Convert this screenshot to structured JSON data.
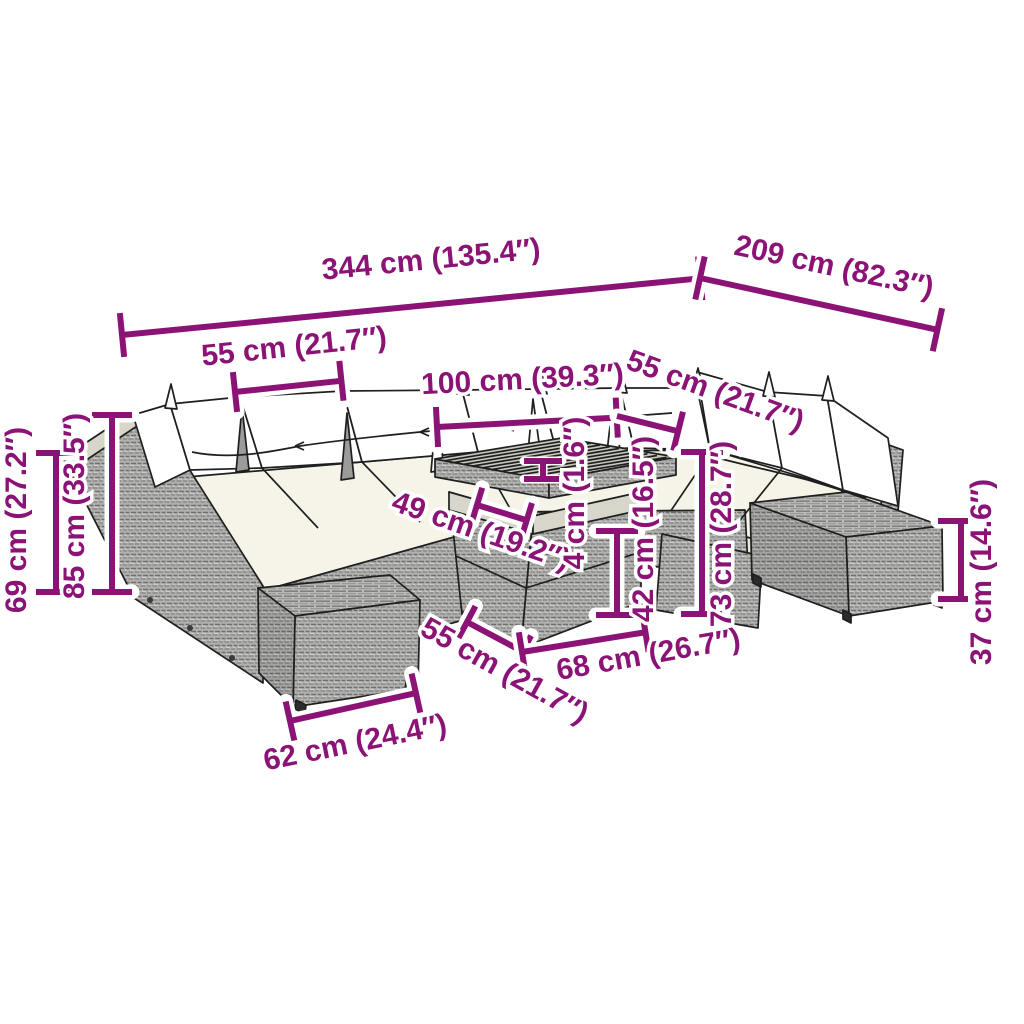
{
  "figure": {
    "type": "product-dimension-diagram",
    "subject": "rattan garden lounge set with corner sofas, coffee table and footstools",
    "accent_color": "#8C1376",
    "background_color": "#FFFFFF",
    "unit_system": "cm and inches"
  },
  "dims": {
    "overall_width": {
      "label": "344 cm (135.4″)",
      "cm": 344,
      "in": 135.4
    },
    "right_depth": {
      "label": "209 cm (82.3″)",
      "cm": 209,
      "in": 82.3
    },
    "seat_width_back_left": {
      "label": "55 cm (21.7″)",
      "cm": 55,
      "in": 21.7
    },
    "corner_opening_width": {
      "label": "100 cm (39.3″)",
      "cm": 100,
      "in": 39.3
    },
    "seat_width_back_right": {
      "label": "55 cm (21.7″)",
      "cm": 55,
      "in": 21.7
    },
    "tabletop_depth": {
      "label": "49 cm (19.2″)",
      "cm": 49,
      "in": 19.2
    },
    "tabletop_thickness": {
      "label": "4 cm (1.6″)",
      "cm": 4,
      "in": 1.6
    },
    "table_height": {
      "label": "42 cm (16.5″)",
      "cm": 42,
      "in": 16.5
    },
    "sofa_height": {
      "label": "73 cm (28.7″)",
      "cm": 73,
      "in": 28.7
    },
    "ottoman_height": {
      "label": "37 cm (14.6″)",
      "cm": 37,
      "in": 14.6
    },
    "armrest_height": {
      "label": "69 cm (27.2″)",
      "cm": 69,
      "in": 27.2
    },
    "backrest_height": {
      "label": "85 cm (33.5″)",
      "cm": 85,
      "in": 33.5
    },
    "ottoman_width": {
      "label": "62 cm (24.4″)",
      "cm": 62,
      "in": 24.4
    },
    "table_depth": {
      "label": "55 cm (21.7″)",
      "cm": 55,
      "in": 21.7
    },
    "table_width": {
      "label": "68 cm (26.7″)",
      "cm": 68,
      "in": 26.7
    }
  }
}
